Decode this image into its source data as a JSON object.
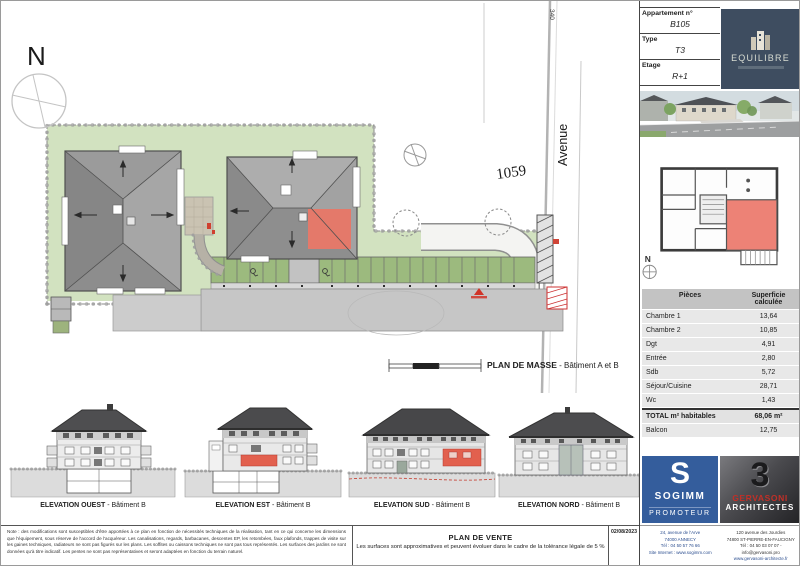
{
  "site_plan": {
    "north": "N",
    "road_ref": "340",
    "avenue": "Avenue",
    "parcel": "1059",
    "caption_title": "PLAN DE MASSE",
    "caption_suffix": " - Bâtiment A et B"
  },
  "elevations": [
    {
      "title": "ELEVATION OUEST",
      "suffix": " - Bâtiment B"
    },
    {
      "title": "ELEVATION EST",
      "suffix": " - Bâtiment B"
    },
    {
      "title": "ELEVATION SUD",
      "suffix": " - Bâtiment B"
    },
    {
      "title": "ELEVATION NORD",
      "suffix": " - Bâtiment B"
    }
  ],
  "apartment": {
    "number_label": "Appartement n°",
    "number": "B105",
    "type_label": "Type",
    "type": "T3",
    "floor_label": "Etage",
    "floor": "R+1"
  },
  "brand": {
    "name": "EQUILIBRE"
  },
  "key_plan": {
    "north": "N"
  },
  "surfaces": {
    "header_label": "Pièces",
    "header_value": "Superficie calculée",
    "rows": [
      {
        "label": "Chambre 1",
        "value": "13,64"
      },
      {
        "label": "Chambre 2",
        "value": "10,85"
      },
      {
        "label": "Dgt",
        "value": "4,91"
      },
      {
        "label": "Entrée",
        "value": "2,80"
      },
      {
        "label": "Sdb",
        "value": "5,72"
      },
      {
        "label": "Séjour/Cuisine",
        "value": "28,71"
      },
      {
        "label": "Wc",
        "value": "1,43"
      }
    ],
    "total_label": "TOTAL m² habitables",
    "total_value": "68,06 m²",
    "balcony_label": "Balcon",
    "balcony_value": "12,75"
  },
  "promoter": {
    "monogram": "S",
    "name": "SOGIMM",
    "role": "PROMOTEUR",
    "address_lines": [
      "24, avenue de l'Arve",
      "74000 ANNECY",
      "Tél : 04 50 57 76 66",
      "Site Internet : www.sogimm.com"
    ]
  },
  "architect": {
    "glyph": "3",
    "name": "GERVASONI",
    "role": "ARCHITECTES",
    "address_lines": [
      "120 avenue des Jourdies",
      "74800 ST-PIERRE-EN-FAUCIGNY",
      "Tél : 04 50 03 07 07 - info@gervasoni.pro",
      "www.gervasoni-architecte.fr"
    ]
  },
  "footer": {
    "note": "Note : des modifications sont susceptibles d'être apportées à ce plan en fonction de nécessités techniques de la réalisation, tant en ce qui concerne les dimensions que l'équipement, sous réserve de l'accord de l'acquéreur. Les canalisations, regards, barbacanes, descentes EP, les retombées, faux plafonds, trappes de visite sur les gaines techniques, radiateurs ne sont pas figurés sur les plans. Les soffites ou caissons techniques ne sont pas tous représentés. Les surfaces des jardins ne sont données qu'à titre indicatif. Les pentes ne sont pas représentatives et seront adaptées en fonction du terrain naturel.",
    "title": "PLAN DE VENTE",
    "subtitle": "Les surfaces sont approximatives et peuvent évoluer dans le cadre de la tolérance légale de 5 %",
    "date": "02/08/2023"
  },
  "colors": {
    "highlight": "#e4796a",
    "brand_navy": "#3e4d60",
    "promoter_blue": "#345d9c",
    "architect_red": "#c03028",
    "site_green": "#d2e2c0"
  }
}
